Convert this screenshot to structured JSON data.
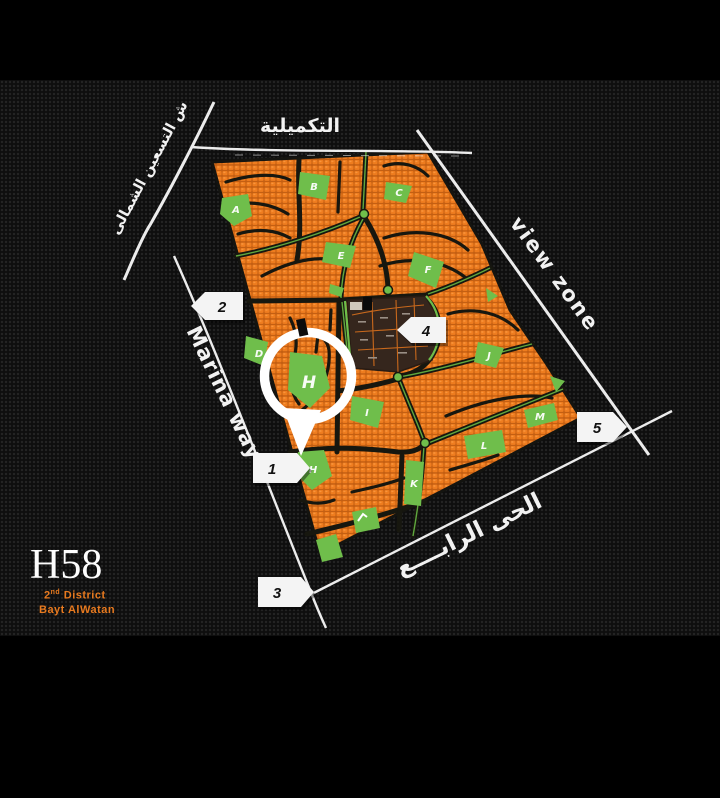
{
  "title_block": {
    "code": "H58",
    "district_number": "2",
    "district_suffix": "nd",
    "district_word": "District",
    "project": "Bayt  AlWatan"
  },
  "road_labels": {
    "top": "التكميلية",
    "northwest": "ش التسعين الشمالى",
    "west": "Marina way",
    "east": "view zone",
    "south": "الحى الرابــــع"
  },
  "entrance_markers": [
    {
      "label": "1"
    },
    {
      "label": "2"
    },
    {
      "label": "3"
    },
    {
      "label": "4"
    },
    {
      "label": "5"
    }
  ],
  "section_labels": [
    {
      "label": "A"
    },
    {
      "label": "B"
    },
    {
      "label": "C"
    },
    {
      "label": "D"
    },
    {
      "label": "E"
    },
    {
      "label": "F"
    },
    {
      "label": "H"
    },
    {
      "label": "I"
    },
    {
      "label": "J"
    },
    {
      "label": "K"
    },
    {
      "label": "L"
    },
    {
      "label": "M"
    },
    {
      "label": "H"
    }
  ],
  "highlight": {
    "section": "H"
  },
  "colors": {
    "plot_orange": "#ee7c1e",
    "park_green": "#6fbe4b",
    "special_brown": "#35261d",
    "road_white": "#ececec",
    "accent_orange": "#e87a1f"
  }
}
